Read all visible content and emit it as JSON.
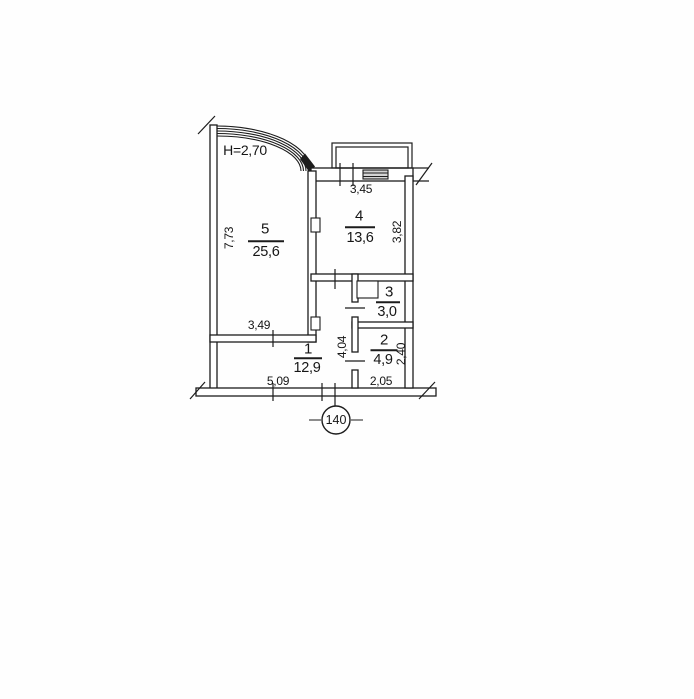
{
  "plan": {
    "ceiling_height_label": "H=2,70",
    "apartment_number": "140",
    "rooms": [
      {
        "number": "5",
        "area": "25,6"
      },
      {
        "number": "4",
        "area": "13,6"
      },
      {
        "number": "3",
        "area": "3,0"
      },
      {
        "number": "2",
        "area": "4,9"
      },
      {
        "number": "1",
        "area": "12,9"
      }
    ],
    "dimensions": {
      "left_wall": "7,73",
      "room4_width": "3,45",
      "room4_depth": "3,82",
      "room5_width": "3,49",
      "hall_depth": "4,04",
      "room2_depth": "2,40",
      "room1_width": "5,09",
      "room2_width": "2,05"
    },
    "colors": {
      "line": "#1c1c1c",
      "paper": "#ffffff",
      "window_fill": "#d4d4d4"
    }
  }
}
